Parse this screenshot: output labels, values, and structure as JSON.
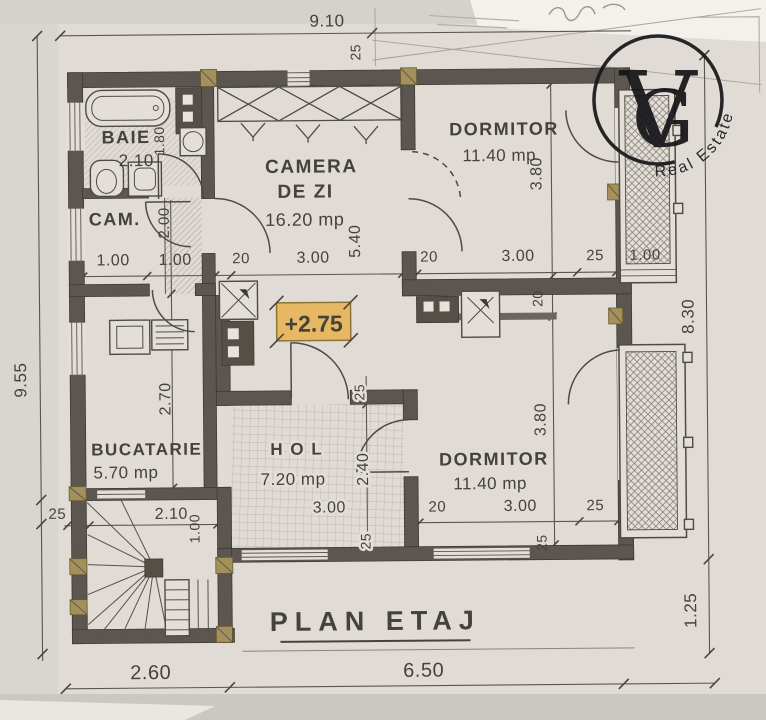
{
  "colors": {
    "highlight": "#e7b863",
    "wall": "#5b564f",
    "paper": "#e3dfd8",
    "ink": "#45413b",
    "khaki": "#a3905a"
  },
  "logo": {
    "v": "V",
    "g": "G",
    "subtitle": "Real Estate"
  },
  "title": "PLAN ETAJ",
  "marker": "+2.75",
  "rooms": {
    "baie": {
      "name": "BAIE",
      "width": "2.10",
      "depth": "1.80"
    },
    "cam": {
      "name": "CAM.",
      "width": "1.00"
    },
    "living": {
      "name1": "CAMERA",
      "name2": "DE ZI",
      "area": "16.20 mp",
      "width": "3.00",
      "depth": "5.40"
    },
    "dorm1": {
      "name": "DORMITOR",
      "area": "11.40 mp",
      "width": "3.00",
      "depth": "3.80",
      "offset": "20",
      "wall": "25"
    },
    "kitchen": {
      "name": "BUCATARIE",
      "area": "5.70 mp",
      "depth": "2.70"
    },
    "hol": {
      "name": "H O L",
      "area": "7.20 mp",
      "width": "3.00",
      "depth": "2.40",
      "wall_top": "25",
      "wall_bottom": "25"
    },
    "dorm2": {
      "name": "DORMITOR",
      "area": "11.40 mp",
      "width": "3.00",
      "depth": "3.80",
      "offset": "20",
      "wall": "25",
      "wall_bottom": "25"
    }
  },
  "dims": {
    "total_width": "9.10",
    "total_height": "9.55",
    "right_height": "8.30",
    "right_drop": "1.25",
    "bottom_left": "2.60",
    "bottom_right": "6.50",
    "top_wall": "25",
    "left_wall": "25",
    "mid_wall": "20",
    "stair_width": "1.00",
    "landing_wall": "20",
    "balcony_width": "1.00",
    "stair_depth": "2.00",
    "stair_run": "2.10",
    "stair_exit": "1.00"
  }
}
